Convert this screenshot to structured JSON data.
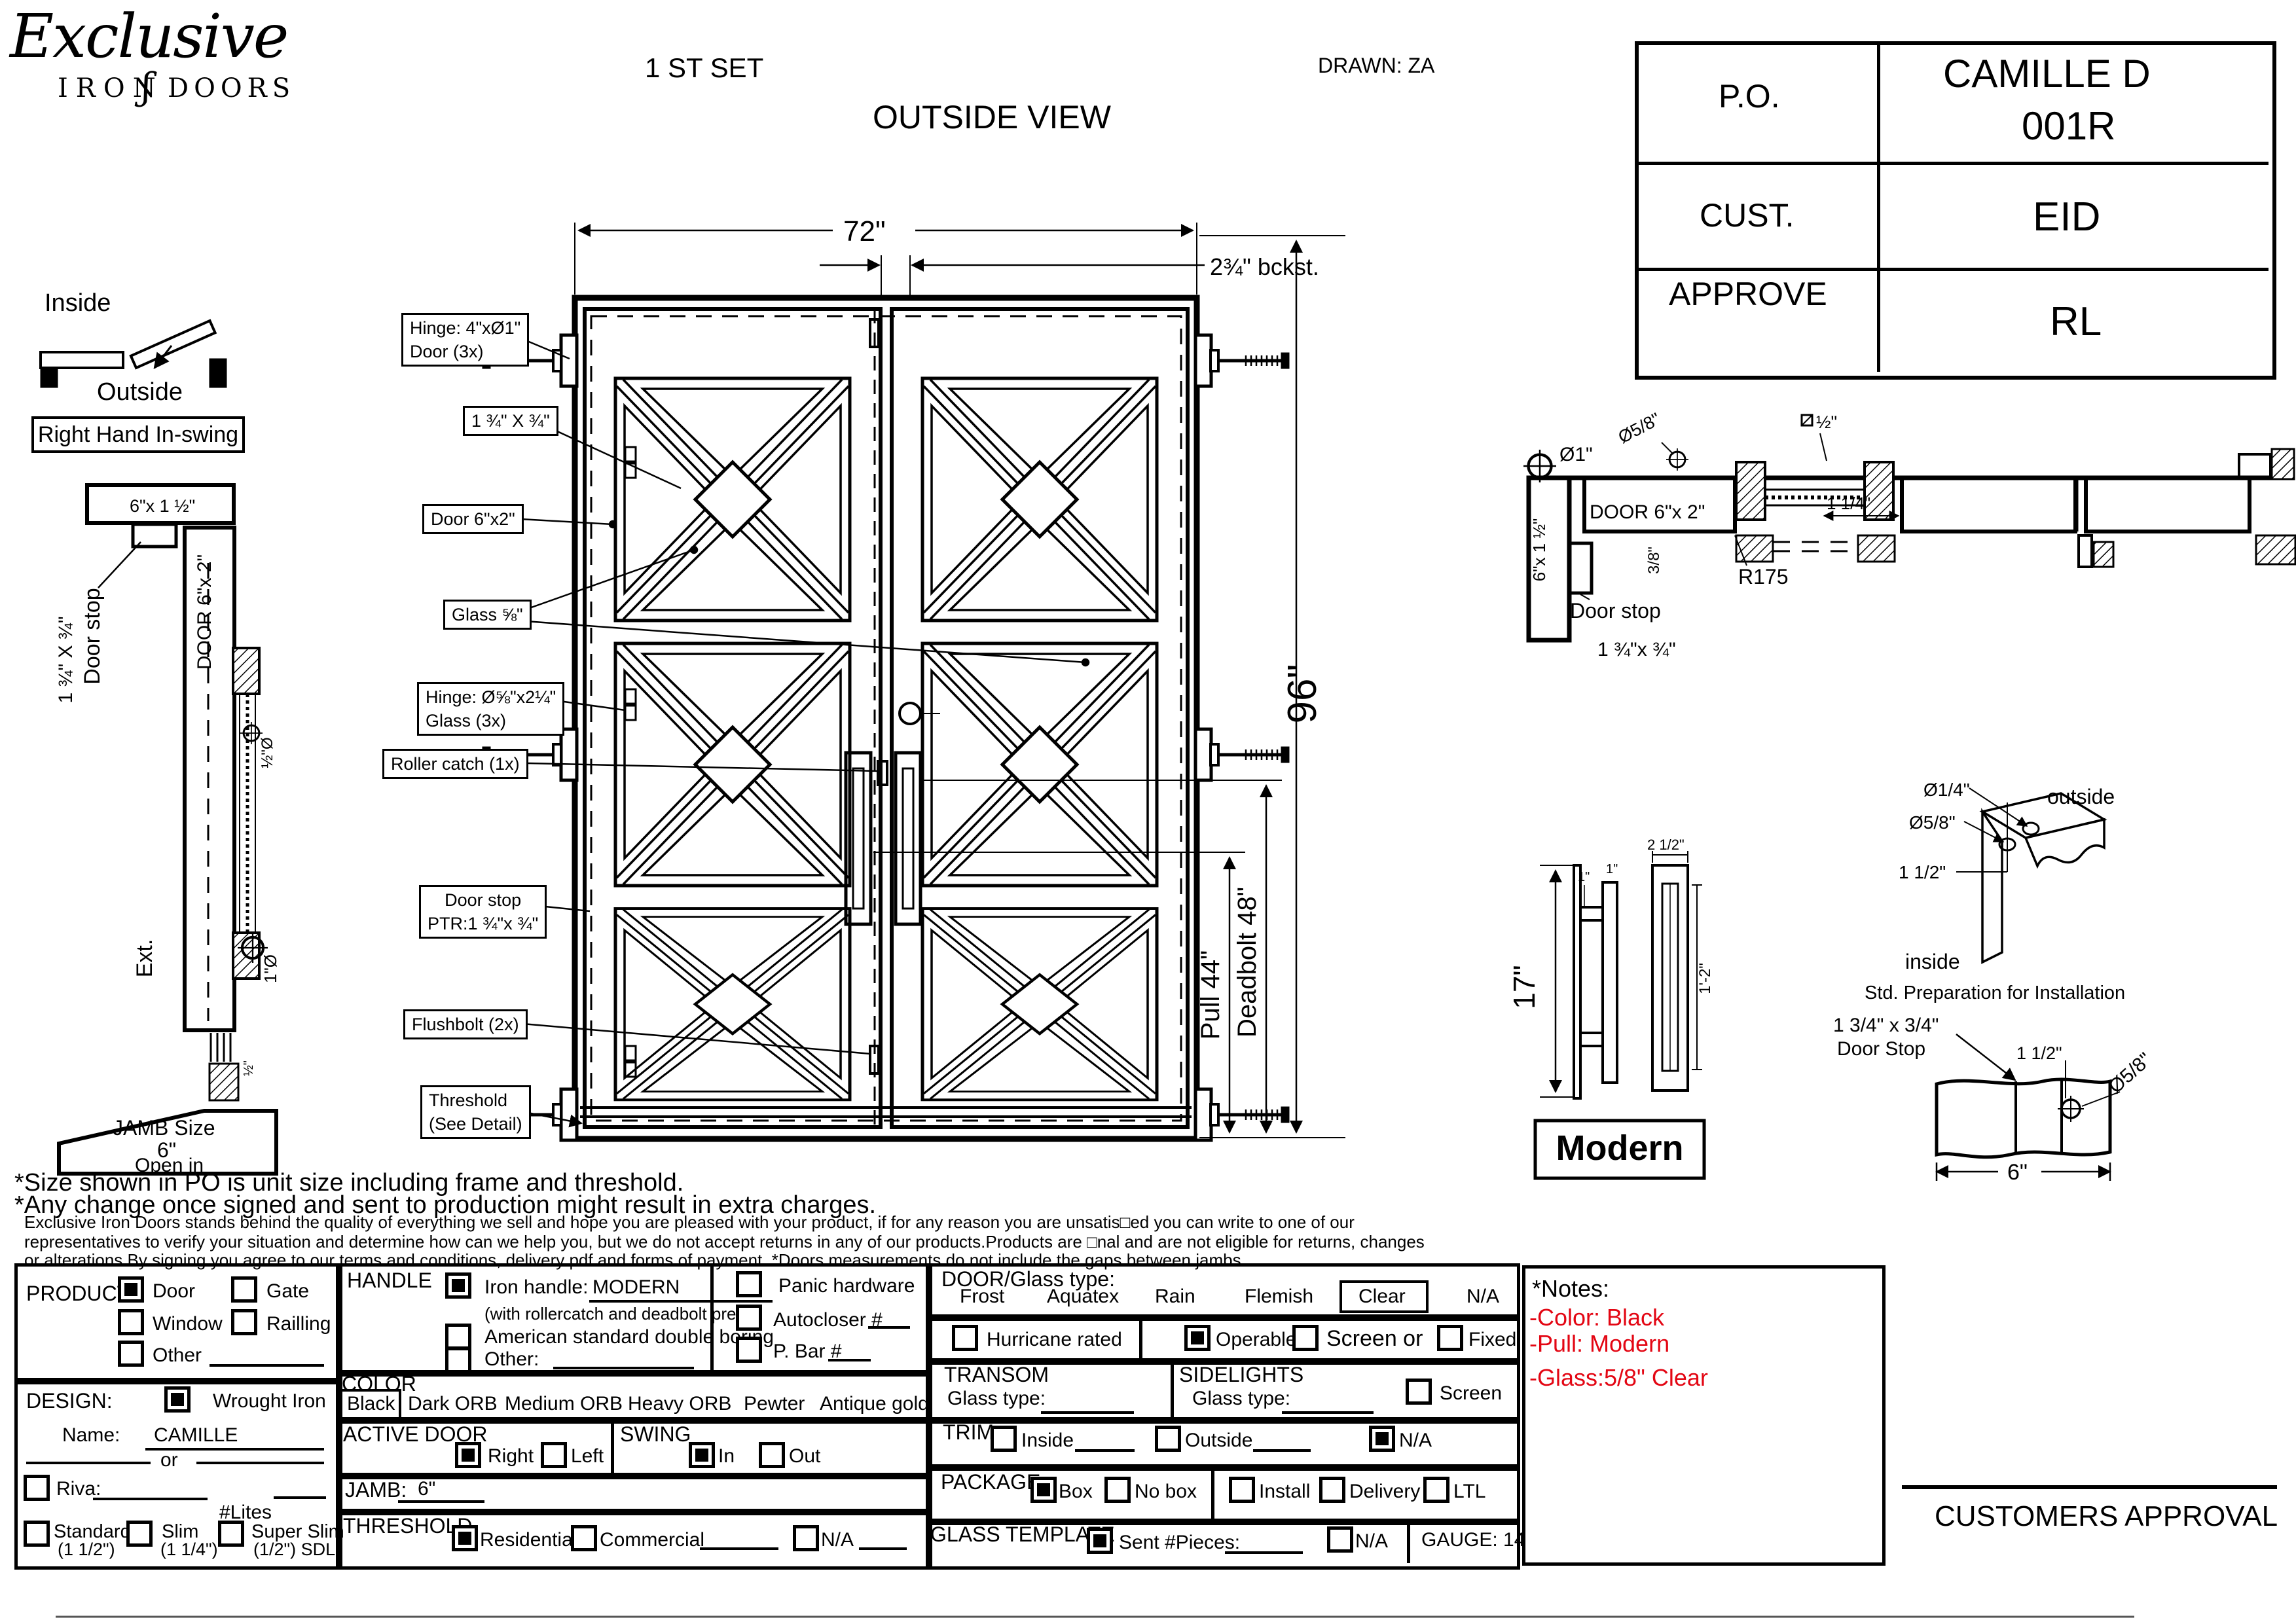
{
  "header": {
    "logo_script": "Exclusive",
    "logo_iron": "IRON",
    "logo_flourish": "ʃ",
    "logo_doors": "DOORS",
    "set_label": "1 ST SET",
    "view_label": "OUTSIDE VIEW",
    "drawn_label": "DRAWN: ZA"
  },
  "info_table": {
    "po_label": "P.O.",
    "po_value_1": "CAMILLE D",
    "po_value_2": "001R",
    "cust_label": "CUST.",
    "cust_value": "EID",
    "approve_label": "APPROVE",
    "approve_value": "RL"
  },
  "swing_diagram": {
    "inside": "Inside",
    "outside": "Outside",
    "handing": "Right Hand In-swing"
  },
  "jamb_section": {
    "header_size": "6\"x 1 ½\"",
    "door_stop": "Door stop",
    "door_stop_size": "1 ¾\" X ¾\"",
    "door_tube": "DOOR 6\"x 2\"",
    "dia_half": "½\"Ø",
    "dia_one": "1\"Ø",
    "ext": "Ext.",
    "half": "½\"",
    "jamb_size_1": "JAMB Size",
    "jamb_size_2": "6\"",
    "jamb_size_3": "Open in"
  },
  "main_drawing": {
    "dim_width": "72\"",
    "dim_backset": "2¾\" bckst.",
    "dim_height": "96\"",
    "dim_pull": "Pull 44\"",
    "dim_deadbolt": "Deadbolt 48\"",
    "callouts": [
      {
        "l1": "Hinge: 4\"xØ1\"",
        "l2": "Door (3x)"
      },
      {
        "l1": "1 ¾\" X ¾\""
      },
      {
        "l1": "Door 6\"x2\""
      },
      {
        "l1": "Glass ⅝\""
      },
      {
        "l1": "Hinge: Ø⅝\"x2¼\"",
        "l2": "Glass (3x)"
      },
      {
        "l1": "Roller catch  (1x)"
      },
      {
        "l1": "Door stop",
        "l2": "PTR:1 ¾\"x ¾\""
      },
      {
        "l1": "Flushbolt (2x)"
      },
      {
        "l1": "Threshold",
        "l2": "(See Detail)"
      }
    ]
  },
  "head_section": {
    "dia_one": "Ø1\"",
    "dia_58": "Ø5/8\"",
    "half": "½\"",
    "door_tube": "DOOR 6\"x 2\"",
    "dim_114": "1 1/4\"",
    "radius": "R175",
    "dim_38": "3/8\"",
    "jamb_size": "6\"x 1 ½\"",
    "door_stop": "Door stop",
    "stop_size": "1 ¾\"x ¾\""
  },
  "handle_detail": {
    "height": "17\"",
    "one_a": "1\"",
    "one_b": "1\"",
    "width": "2 1/2\"",
    "inner": "1'-2\"",
    "name": "Modern"
  },
  "install_detail": {
    "dia_14": "Ø1/4\"",
    "dia_58": "Ø5/8\"",
    "dim": "1 1/2\"",
    "outside": "outside",
    "inside": "inside",
    "caption": "Std. Preparation for Installation"
  },
  "stop_detail": {
    "size_1": "1 3/4\" x 3/4\"",
    "size_2": "Door Stop",
    "dim_112": "1 1/2\"",
    "dia_58": "Ø5/8\"",
    "dim_6": "6\""
  },
  "disclaimer": {
    "line1": "*Size shown in PO is unit size including frame and threshold.",
    "line2": "*Any change once signed and sent to production might result in extra charges.",
    "line3": "Exclusive Iron Doors stands behind the quality of everything we sell and hope you are pleased with your product, if for any reason you are unsatis□ed you can write to one of our",
    "line4": "representatives to verify your situation and determine how can we help you, but we do not accept returns in any of our products.Products are □nal and are not eligible for returns, changes",
    "line5": "or alterations.By signing you agree to our terms and conditions, delivery pdf and forms of payment. *Doors measurements do not include the gaps between jambs"
  },
  "form": {
    "product": {
      "label": "PRODUCT:",
      "door": "Door",
      "gate": "Gate",
      "window": "Window",
      "railing": "Railling",
      "other": "Other"
    },
    "design": {
      "label": "DESIGN:",
      "wrought": "Wrought Iron",
      "name_label": "Name:",
      "name_value": "CAMILLE",
      "or": "or",
      "riva": "Riva:",
      "lites": "#Lites",
      "standard": "Standard",
      "standard_sub": "(1 1/2\")",
      "slim": "Slim",
      "slim_sub": "(1 1/4\")",
      "superslim": "Super Slim",
      "superslim_sub": "(1/2\") SDL"
    },
    "handle": {
      "label": "HANDLE",
      "iron": "Iron handle:",
      "iron_value": "MODERN",
      "prep": "(with rollercatch and deadbolt prep)",
      "american": "American standard double boring",
      "other": "Other:",
      "panic": "Panic hardware",
      "autocloser": "Autocloser #",
      "pbar": "P. Bar #"
    },
    "color": {
      "label": "COLOR",
      "black": "Black",
      "dark": "Dark ORB",
      "medium": "Medium ORB",
      "heavy": "Heavy ORB",
      "pewter": "Pewter",
      "antique": "Antique gold"
    },
    "active": {
      "label": "ACTIVE DOOR",
      "right": "Right",
      "left": "Left"
    },
    "swing": {
      "label": "SWING",
      "in": "In",
      "out": "Out"
    },
    "jamb": {
      "label": "JAMB:",
      "value": "6\""
    },
    "threshold": {
      "label": "THRESHOLD",
      "residential": "Residential",
      "commercial": "Commercial",
      "na": "N/A"
    },
    "glass": {
      "label": "DOOR/Glass type:",
      "frost": "Frost",
      "aquatex": "Aquatex",
      "rain": "Rain",
      "flemish": "Flemish",
      "clear": "Clear",
      "na": "N/A"
    },
    "rated": {
      "hurricane": "Hurricane rated",
      "operable": "Operable",
      "screen_or": "Screen or",
      "fixed": "Fixed"
    },
    "transom": {
      "label": "TRANSOM",
      "glass_type": "Glass type:"
    },
    "sidelights": {
      "label": "SIDELIGHTS",
      "glass_type": "Glass type:",
      "screen": "Screen"
    },
    "trim": {
      "label": "TRIM",
      "inside": "Inside",
      "outside": "Outside",
      "na": "N/A"
    },
    "package": {
      "label": "PACKAGE",
      "box": "Box",
      "nobox": "No box",
      "install": "Install",
      "delivery": "Delivery",
      "ltl": "LTL"
    },
    "template": {
      "label": "GLASS TEMPLATE",
      "sent": "Sent #Pieces:",
      "na": "N/A"
    },
    "gauge": {
      "label": "GAUGE: 14"
    }
  },
  "checks": {
    "product_door": true,
    "product_gate": false,
    "product_window": false,
    "product_railing": false,
    "product_other": false,
    "design_wrought": true,
    "riva": false,
    "standard": false,
    "slim": false,
    "superslim": false,
    "handle_iron": true,
    "handle_american": false,
    "handle_other": false,
    "panic": false,
    "autocloser": false,
    "pbar": false,
    "color_black": true,
    "glass_clear": true,
    "hurricane": false,
    "operable": true,
    "screen_or": false,
    "fixed": false,
    "sidelights_screen": false,
    "active_right": true,
    "active_left": false,
    "swing_in": true,
    "swing_out": false,
    "threshold_residential": true,
    "threshold_commercial": false,
    "threshold_na": false,
    "trim_inside": false,
    "trim_outside": false,
    "trim_na": true,
    "package_box": true,
    "package_nobox": false,
    "package_install": false,
    "package_delivery": false,
    "package_ltl": false,
    "template_sent": true,
    "template_na": false
  },
  "notes_box": {
    "title": "*Notes:",
    "color_note": "-Color: Black",
    "pull_note": "-Pull: Modern",
    "glass_note": "-Glass:5/8\"   Clear",
    "red": "#e30613"
  },
  "approval": {
    "label": "CUSTOMERS APPROVAL"
  }
}
